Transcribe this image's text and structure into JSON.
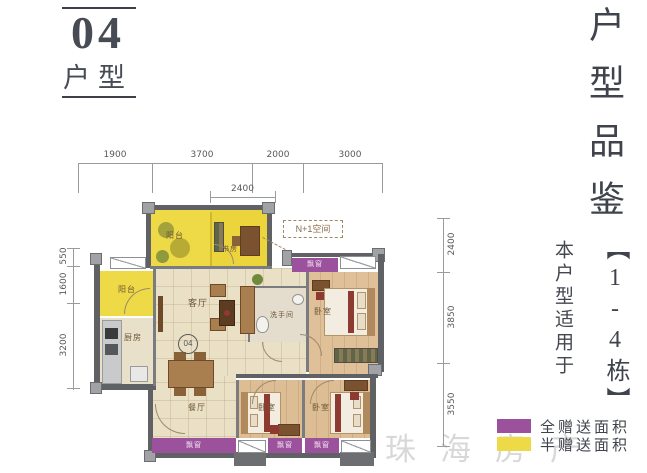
{
  "header": {
    "number": "04",
    "label": "户型"
  },
  "side": {
    "title": "户型品鉴",
    "building": "【1-4栋】",
    "applies": "本户型适用于"
  },
  "legend": {
    "full_label": "全赠送面积",
    "half_label": "半赠送面积"
  },
  "watermark": "珠海房产",
  "dims": {
    "top": [
      "1900",
      "3700",
      "2000",
      "3000"
    ],
    "top2": "2400",
    "right": [
      "2400",
      "3850",
      "3550"
    ],
    "left": [
      "550",
      "1600",
      "3200"
    ]
  },
  "rooms": {
    "balcony_top": "阳台",
    "study": "书房",
    "nplus1": "N+1空间",
    "balcony_left": "阳台",
    "kitchen": "厨房",
    "living": "客厅",
    "unit_circle": "04",
    "bath": "洗手间",
    "master": "卧室",
    "dining": "餐厅",
    "bed_a": "卧室",
    "bed_b": "卧室",
    "bay_label": "飘窗"
  },
  "colors": {
    "purple": "#9b519c",
    "yellow": "#eed946",
    "wall": "#606165",
    "accent_red": "#8d3a30"
  }
}
